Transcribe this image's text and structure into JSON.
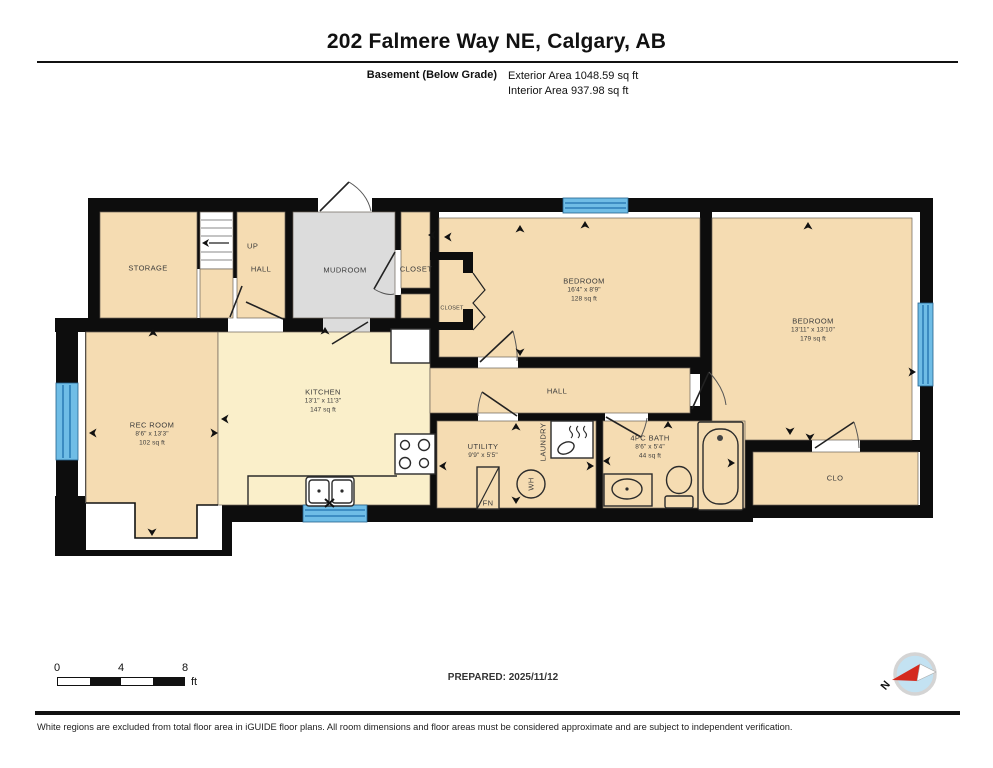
{
  "header": {
    "title": "202 Falmere Way NE, Calgary, AB",
    "floor_label": "Basement (Below Grade)",
    "exterior_area": "Exterior Area 1048.59 sq ft",
    "interior_area": "Interior Area 937.98 sq ft"
  },
  "rooms": {
    "storage": {
      "name": "STORAGE"
    },
    "stairs": {
      "label": "UP"
    },
    "hall_upper": {
      "name": "HALL"
    },
    "mudroom": {
      "name": "MUDROOM"
    },
    "closet_main": {
      "name": "CLOSET"
    },
    "bedroom1_closet": {
      "name": "CLOSET"
    },
    "bedroom1": {
      "name": "BEDROOM",
      "dims": "16'4\" x 8'9\"",
      "area": "128 sq ft"
    },
    "bedroom2": {
      "name": "BEDROOM",
      "dims": "13'11\" x 13'10\"",
      "area": "179 sq ft"
    },
    "rec_room": {
      "name": "REC ROOM",
      "dims": "8'6\" x 13'3\"",
      "area": "102 sq ft"
    },
    "kitchen": {
      "name": "KITCHEN",
      "dims": "13'1\" x 11'3\"",
      "area": "147 sq ft"
    },
    "hall_main": {
      "name": "HALL"
    },
    "utility": {
      "name": "UTILITY",
      "dims": "9'9\" x 5'5\""
    },
    "laundry": {
      "name": "LAUNDRY"
    },
    "bath": {
      "name": "4PC BATH",
      "dims": "8'6\" x 5'4\"",
      "area": "44 sq ft"
    },
    "clo": {
      "name": "CLO"
    },
    "furnace": {
      "name": "FN"
    },
    "water_heater": {
      "name": "WH"
    }
  },
  "scale_bar": {
    "ticks": [
      "0",
      "4",
      "8"
    ],
    "unit": "ft"
  },
  "footer": {
    "prepared": "PREPARED: 2025/11/12",
    "north": "N",
    "disclaimer": "White regions are excluded from total floor area in iGUIDE floor plans. All room dimensions and floor areas must be considered approximate and are subject to independent verification."
  },
  "colors": {
    "wall": "#0d0d0d",
    "room_tan": "#f5dcb2",
    "room_light": "#faefca",
    "mudroom_gray": "#dcdcdc",
    "window_blue": "#6fbde6",
    "window_blue_dark": "#2e7fb8",
    "compass_red": "#d42a1e",
    "compass_blue": "#c3e2f2"
  }
}
